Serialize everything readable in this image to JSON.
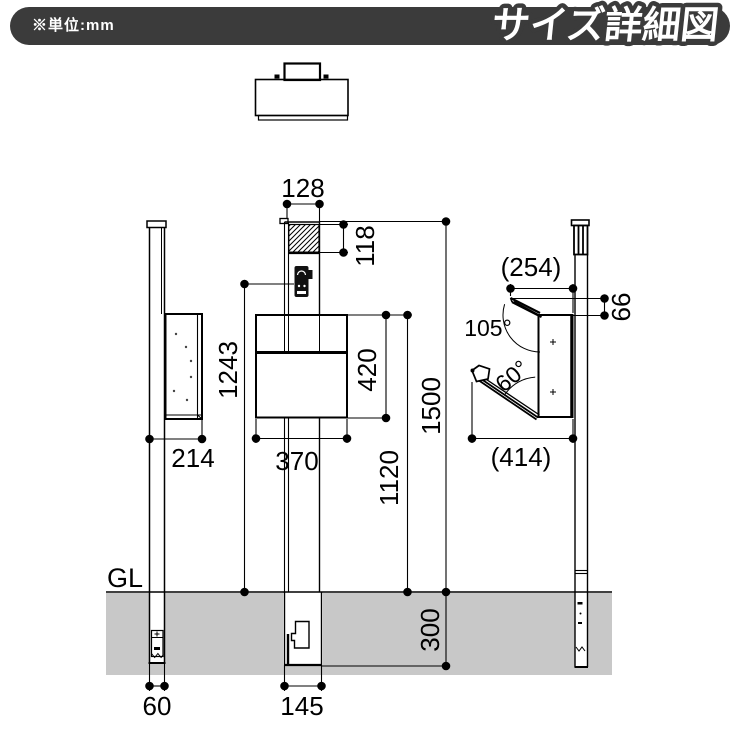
{
  "header": {
    "unit_note": "※単位:mm",
    "title": "サイズ詳細図"
  },
  "colors": {
    "banner": "#3b3b3b",
    "ground": "#c8c8c8",
    "line": "#000000",
    "title_text": "#ffffff"
  },
  "dims": {
    "pole_width": "128",
    "cover_height": "118",
    "intercom_height": "1243",
    "box_height": "420",
    "box_width": "370",
    "box_top_to_gl": "1120",
    "pole_height": "1500",
    "embed_depth": "300",
    "embed_width": "145",
    "side_depth": "214",
    "pole_side_width": "60",
    "open_top_depth": "(254)",
    "lid_rise": "66",
    "lid_angle": "105°",
    "door_angle": "60°",
    "open_bottom_depth": "(414)",
    "ground_line": "GL"
  }
}
